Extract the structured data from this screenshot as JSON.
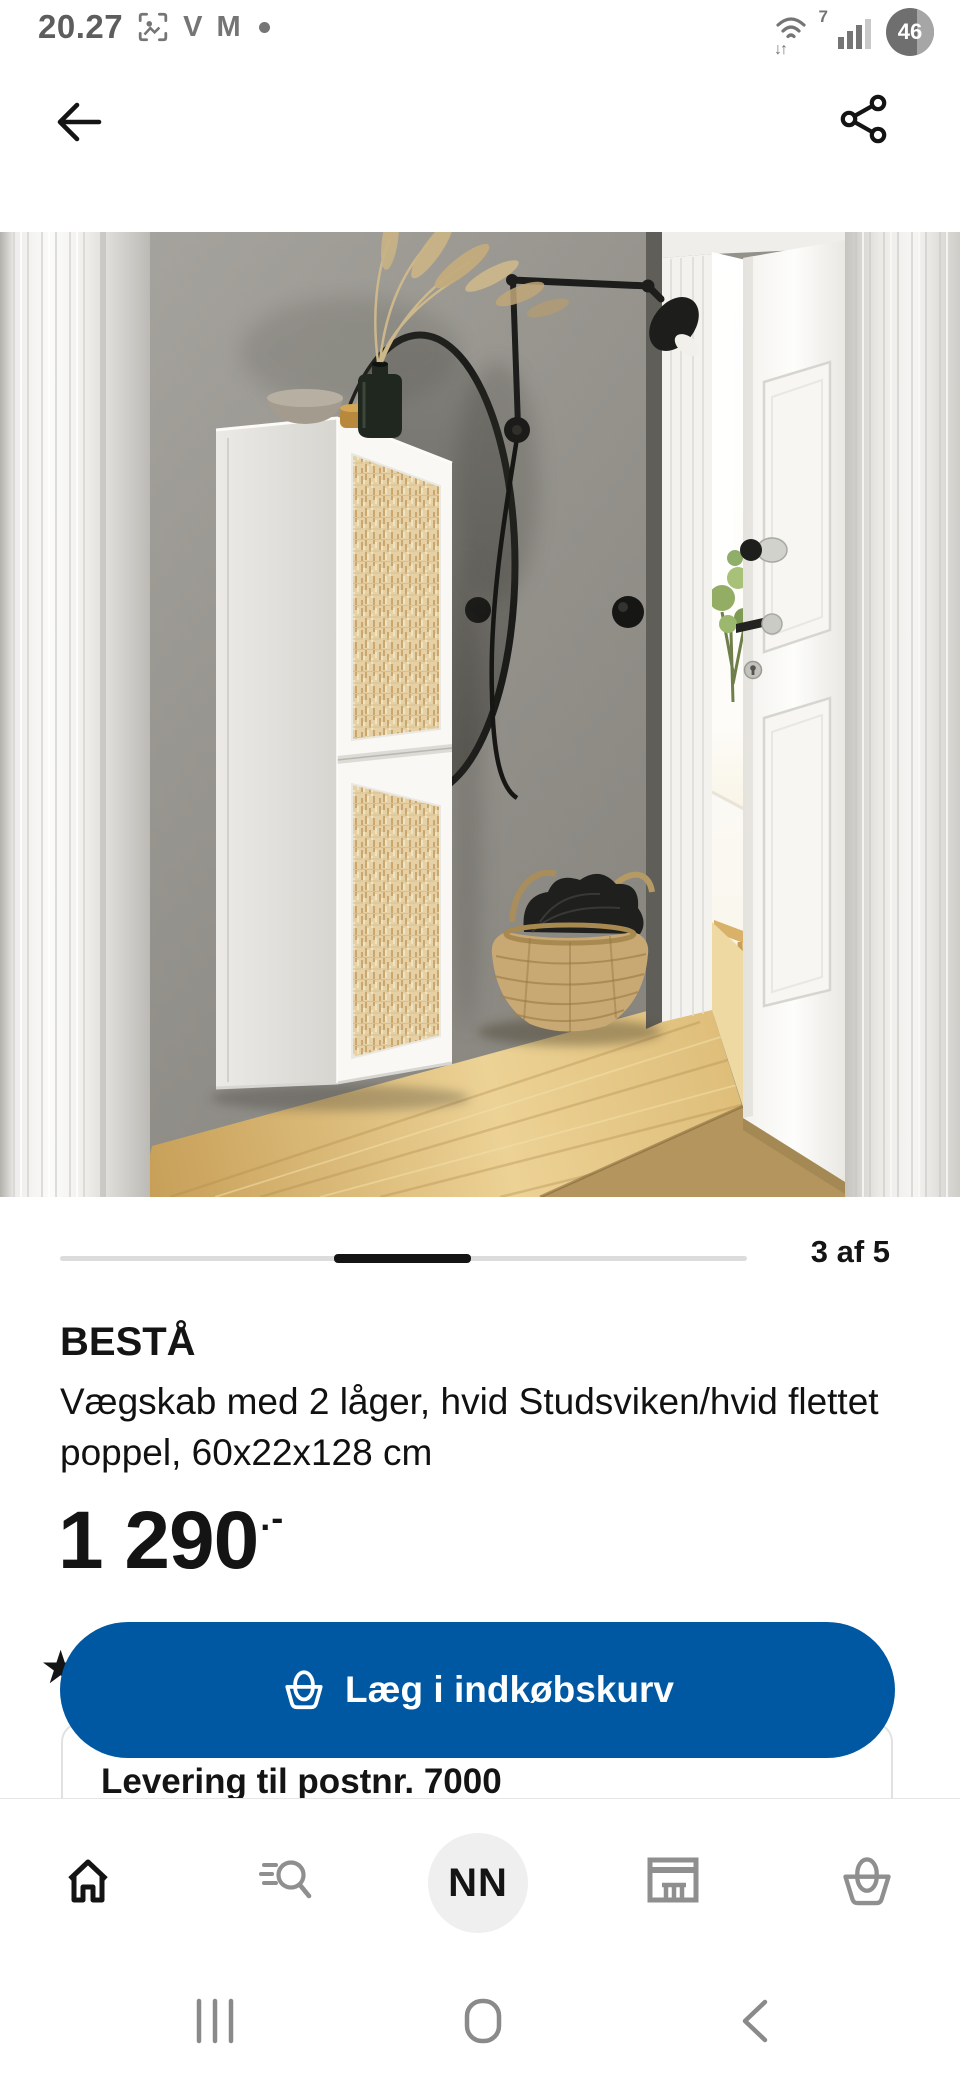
{
  "status_bar": {
    "time": "20.27",
    "v_badge": "V",
    "m_badge": "M",
    "wifi_badge": "7",
    "traffic_arrows": "↓↑",
    "battery_percent": "46"
  },
  "carousel": {
    "position_label": "3 af 5"
  },
  "product": {
    "title": "BESTÅ",
    "description": "Vægskab med 2 låger, hvid Studsviken/hvid flettet poppel, 60x22x128 cm",
    "price": "1 290",
    "price_suffix": ".-"
  },
  "rating": {
    "star_glyph": "★"
  },
  "actions": {
    "add_to_cart_label": "Læg i indkøbskurv"
  },
  "delivery": {
    "title": "Levering til postnr. 7000"
  },
  "bottom_nav": {
    "profile_initials": "NN"
  },
  "colors": {
    "ikea_blue": "#0058A3",
    "text_primary": "#141414",
    "icon_inactive": "#8f8f8f",
    "progress_track": "#dcdcdc",
    "progress_active": "#141414",
    "card_border": "#e1e1e1"
  }
}
